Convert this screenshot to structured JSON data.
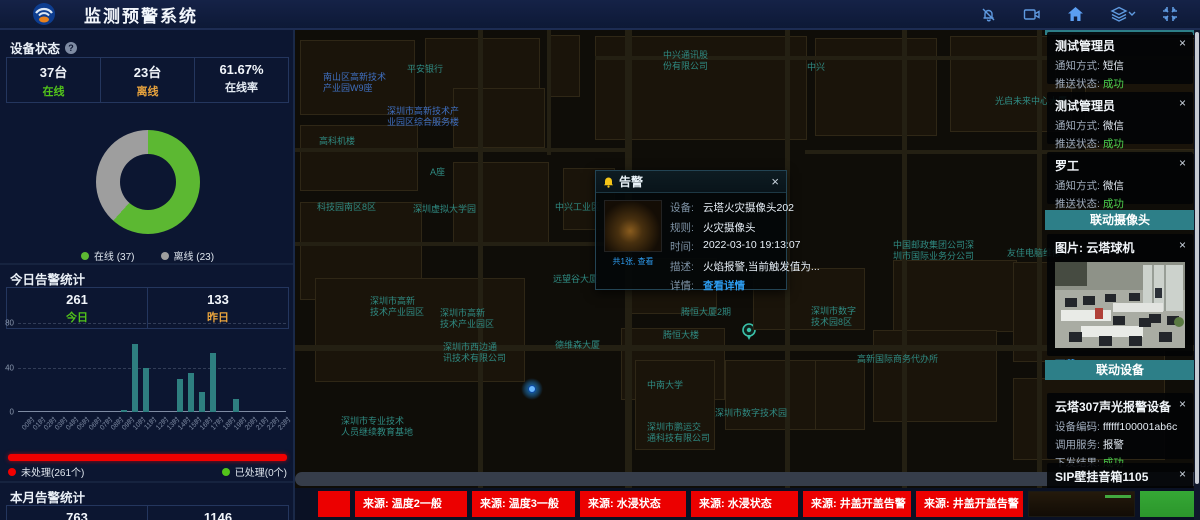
{
  "ui": {
    "close": "×"
  },
  "header": {
    "title": "监测预警系统",
    "icons": [
      "bell-muted",
      "video-camera",
      "home",
      "layers",
      "fullscreen"
    ]
  },
  "device_status": {
    "title": "设备状态",
    "cells": [
      {
        "value": "37台",
        "label": "在线",
        "label_color": "#52c41a"
      },
      {
        "value": "23台",
        "label": "离线",
        "label_color": "#e8a33d"
      },
      {
        "value": "61.67%",
        "label": "在线率",
        "label_color": "#e4ebf3"
      }
    ]
  },
  "today": {
    "title": "今日告警统计",
    "cells": [
      {
        "value": "261",
        "label": "今日",
        "label_color": "#52c41a"
      },
      {
        "value": "133",
        "label": "昨日",
        "label_color": "#e8a33d"
      }
    ]
  },
  "process_legend": {
    "unprocessed": "未处理(261个)",
    "processed": "已处理(0个)",
    "unprocessed_color": "#f20000",
    "processed_color": "#52c41a"
  },
  "month": {
    "title": "本月告警统计",
    "values": [
      "763",
      "1146"
    ]
  },
  "chart_data": [
    {
      "type": "pie",
      "title": "设备状态",
      "labels": [
        "在线",
        "离线"
      ],
      "values": [
        37,
        23
      ],
      "colors": [
        "#5cb832",
        "#9e9e9e"
      ],
      "donut": true,
      "legend": [
        "在线 (37)",
        "离线 (23)"
      ]
    },
    {
      "type": "bar",
      "title": "今日告警统计(按小时)",
      "categories": [
        "00时",
        "01时",
        "02时",
        "03时",
        "04时",
        "05时",
        "06时",
        "07时",
        "08时",
        "09时",
        "10时",
        "11时",
        "12时",
        "13时",
        "14时",
        "15时",
        "16时",
        "17时",
        "18时",
        "19时",
        "20时",
        "21时",
        "22时",
        "23时"
      ],
      "values": [
        0,
        0,
        0,
        0,
        0,
        0,
        0,
        0,
        0,
        2,
        61,
        40,
        0,
        0,
        30,
        35,
        18,
        53,
        0,
        12,
        0,
        0,
        0,
        0
      ],
      "xlabel": "",
      "ylabel": "",
      "ylim": [
        0,
        80
      ],
      "yticks": [
        0,
        40,
        80
      ],
      "bar_color": "#2e7f80",
      "grid": "dashed"
    }
  ],
  "map": {
    "labels": [
      {
        "text": "中兴通讯股\n份有限公司",
        "x": 368,
        "y": 20,
        "color": "teal"
      },
      {
        "text": "中兴",
        "x": 512,
        "y": 32,
        "color": "teal"
      },
      {
        "text": "平安银行",
        "x": 112,
        "y": 34,
        "color": "teal"
      },
      {
        "text": "南山区高新技术\n产业园W9座",
        "x": 28,
        "y": 42,
        "color": "blue"
      },
      {
        "text": "光启未来中心大厦",
        "x": 700,
        "y": 66,
        "color": "teal"
      },
      {
        "text": "深圳市高新技术产\n业园区综合服务楼",
        "x": 92,
        "y": 76,
        "color": "blue"
      },
      {
        "text": "高科机楼",
        "x": 24,
        "y": 106,
        "color": "teal"
      },
      {
        "text": "科技园南区8区",
        "x": 22,
        "y": 172,
        "color": "teal"
      },
      {
        "text": "A座",
        "x": 135,
        "y": 137,
        "color": "teal"
      },
      {
        "text": "深圳虚拟大学园",
        "x": 118,
        "y": 174,
        "color": "teal"
      },
      {
        "text": "中兴工业区",
        "x": 260,
        "y": 172,
        "color": "teal"
      },
      {
        "text": "远望谷大厦",
        "x": 258,
        "y": 244,
        "color": "teal"
      },
      {
        "text": "德维森大厦",
        "x": 260,
        "y": 310,
        "color": "teal"
      },
      {
        "text": "深圳市高新\n技术产业园区",
        "x": 75,
        "y": 266,
        "color": "teal"
      },
      {
        "text": "深圳市高新\n技术产业园区",
        "x": 145,
        "y": 278,
        "color": "teal"
      },
      {
        "text": "深圳市西边通\n讯技术有限公司",
        "x": 148,
        "y": 312,
        "color": "teal"
      },
      {
        "text": "深圳市专业技术\n人员继续教育基地",
        "x": 46,
        "y": 386,
        "color": "teal"
      },
      {
        "text": "中南大学",
        "x": 352,
        "y": 350,
        "color": "teal"
      },
      {
        "text": "深圳市鹏运交\n通科技有限公司",
        "x": 352,
        "y": 392,
        "color": "teal"
      },
      {
        "text": "深圳市数字技术园",
        "x": 420,
        "y": 378,
        "color": "teal"
      },
      {
        "text": "腾恒大厦2期",
        "x": 386,
        "y": 277,
        "color": "teal"
      },
      {
        "text": "腾恒大楼",
        "x": 368,
        "y": 300,
        "color": "teal"
      },
      {
        "text": "中国邮政集团公司深\n圳市国际业务分公司",
        "x": 598,
        "y": 210,
        "color": "teal"
      },
      {
        "text": "友佳电脑维修",
        "x": 712,
        "y": 218,
        "color": "teal"
      },
      {
        "text": "深圳市数字\n技术园8区",
        "x": 516,
        "y": 276,
        "color": "teal"
      },
      {
        "text": "高新国际商务代办所",
        "x": 562,
        "y": 324,
        "color": "teal"
      }
    ]
  },
  "popup": {
    "title": "告警",
    "image_caption": "共1张, 查看",
    "fields": [
      {
        "label": "设备:",
        "value": "云塔火灾摄像头202"
      },
      {
        "label": "规则:",
        "value": "火灾摄像头"
      },
      {
        "label": "时间:",
        "value": "2022-03-10 19:13:07"
      },
      {
        "label": "描述:",
        "value": "火焰报警,当前触发值为..."
      },
      {
        "label": "详情:",
        "value": "查看详情",
        "link": true
      }
    ]
  },
  "right_panel": {
    "notifications": [
      {
        "title": "测试管理员",
        "rows": [
          {
            "label": "通知方式:",
            "value": "短信"
          },
          {
            "label": "推送状态:",
            "value": "成功",
            "ok": true
          }
        ]
      },
      {
        "title": "测试管理员",
        "rows": [
          {
            "label": "通知方式:",
            "value": "微信"
          },
          {
            "label": "推送状态:",
            "value": "成功",
            "ok": true
          }
        ]
      },
      {
        "title": "罗工",
        "rows": [
          {
            "label": "通知方式:",
            "value": "微信"
          },
          {
            "label": "推送状态:",
            "value": "成功",
            "ok": true
          }
        ]
      }
    ],
    "camera_section": "联动摄像头",
    "camera_card": {
      "title": "图片: 云塔球机",
      "download": "下载"
    },
    "device_section": "联动设备",
    "device_cards": [
      {
        "title": "云塔307声光报警设备",
        "rows": [
          {
            "label": "设备编码:",
            "value": "ffffff100001ab6c"
          },
          {
            "label": "调用服务:",
            "value": "报警"
          },
          {
            "label": "下发结果:",
            "value": "成功",
            "ok": true
          }
        ]
      },
      {
        "title": "SIP壁挂音箱1105",
        "rows": [
          {
            "label": "设备编码:",
            "value": "1105"
          }
        ]
      }
    ]
  },
  "bottom_alerts": {
    "items": [
      "",
      "来源: 温度2一般",
      "来源: 温度3一般",
      "来源: 水浸状态",
      "来源: 水浸状态",
      "来源: 井盖开盖告警",
      "来源: 井盖开盖告警"
    ]
  }
}
